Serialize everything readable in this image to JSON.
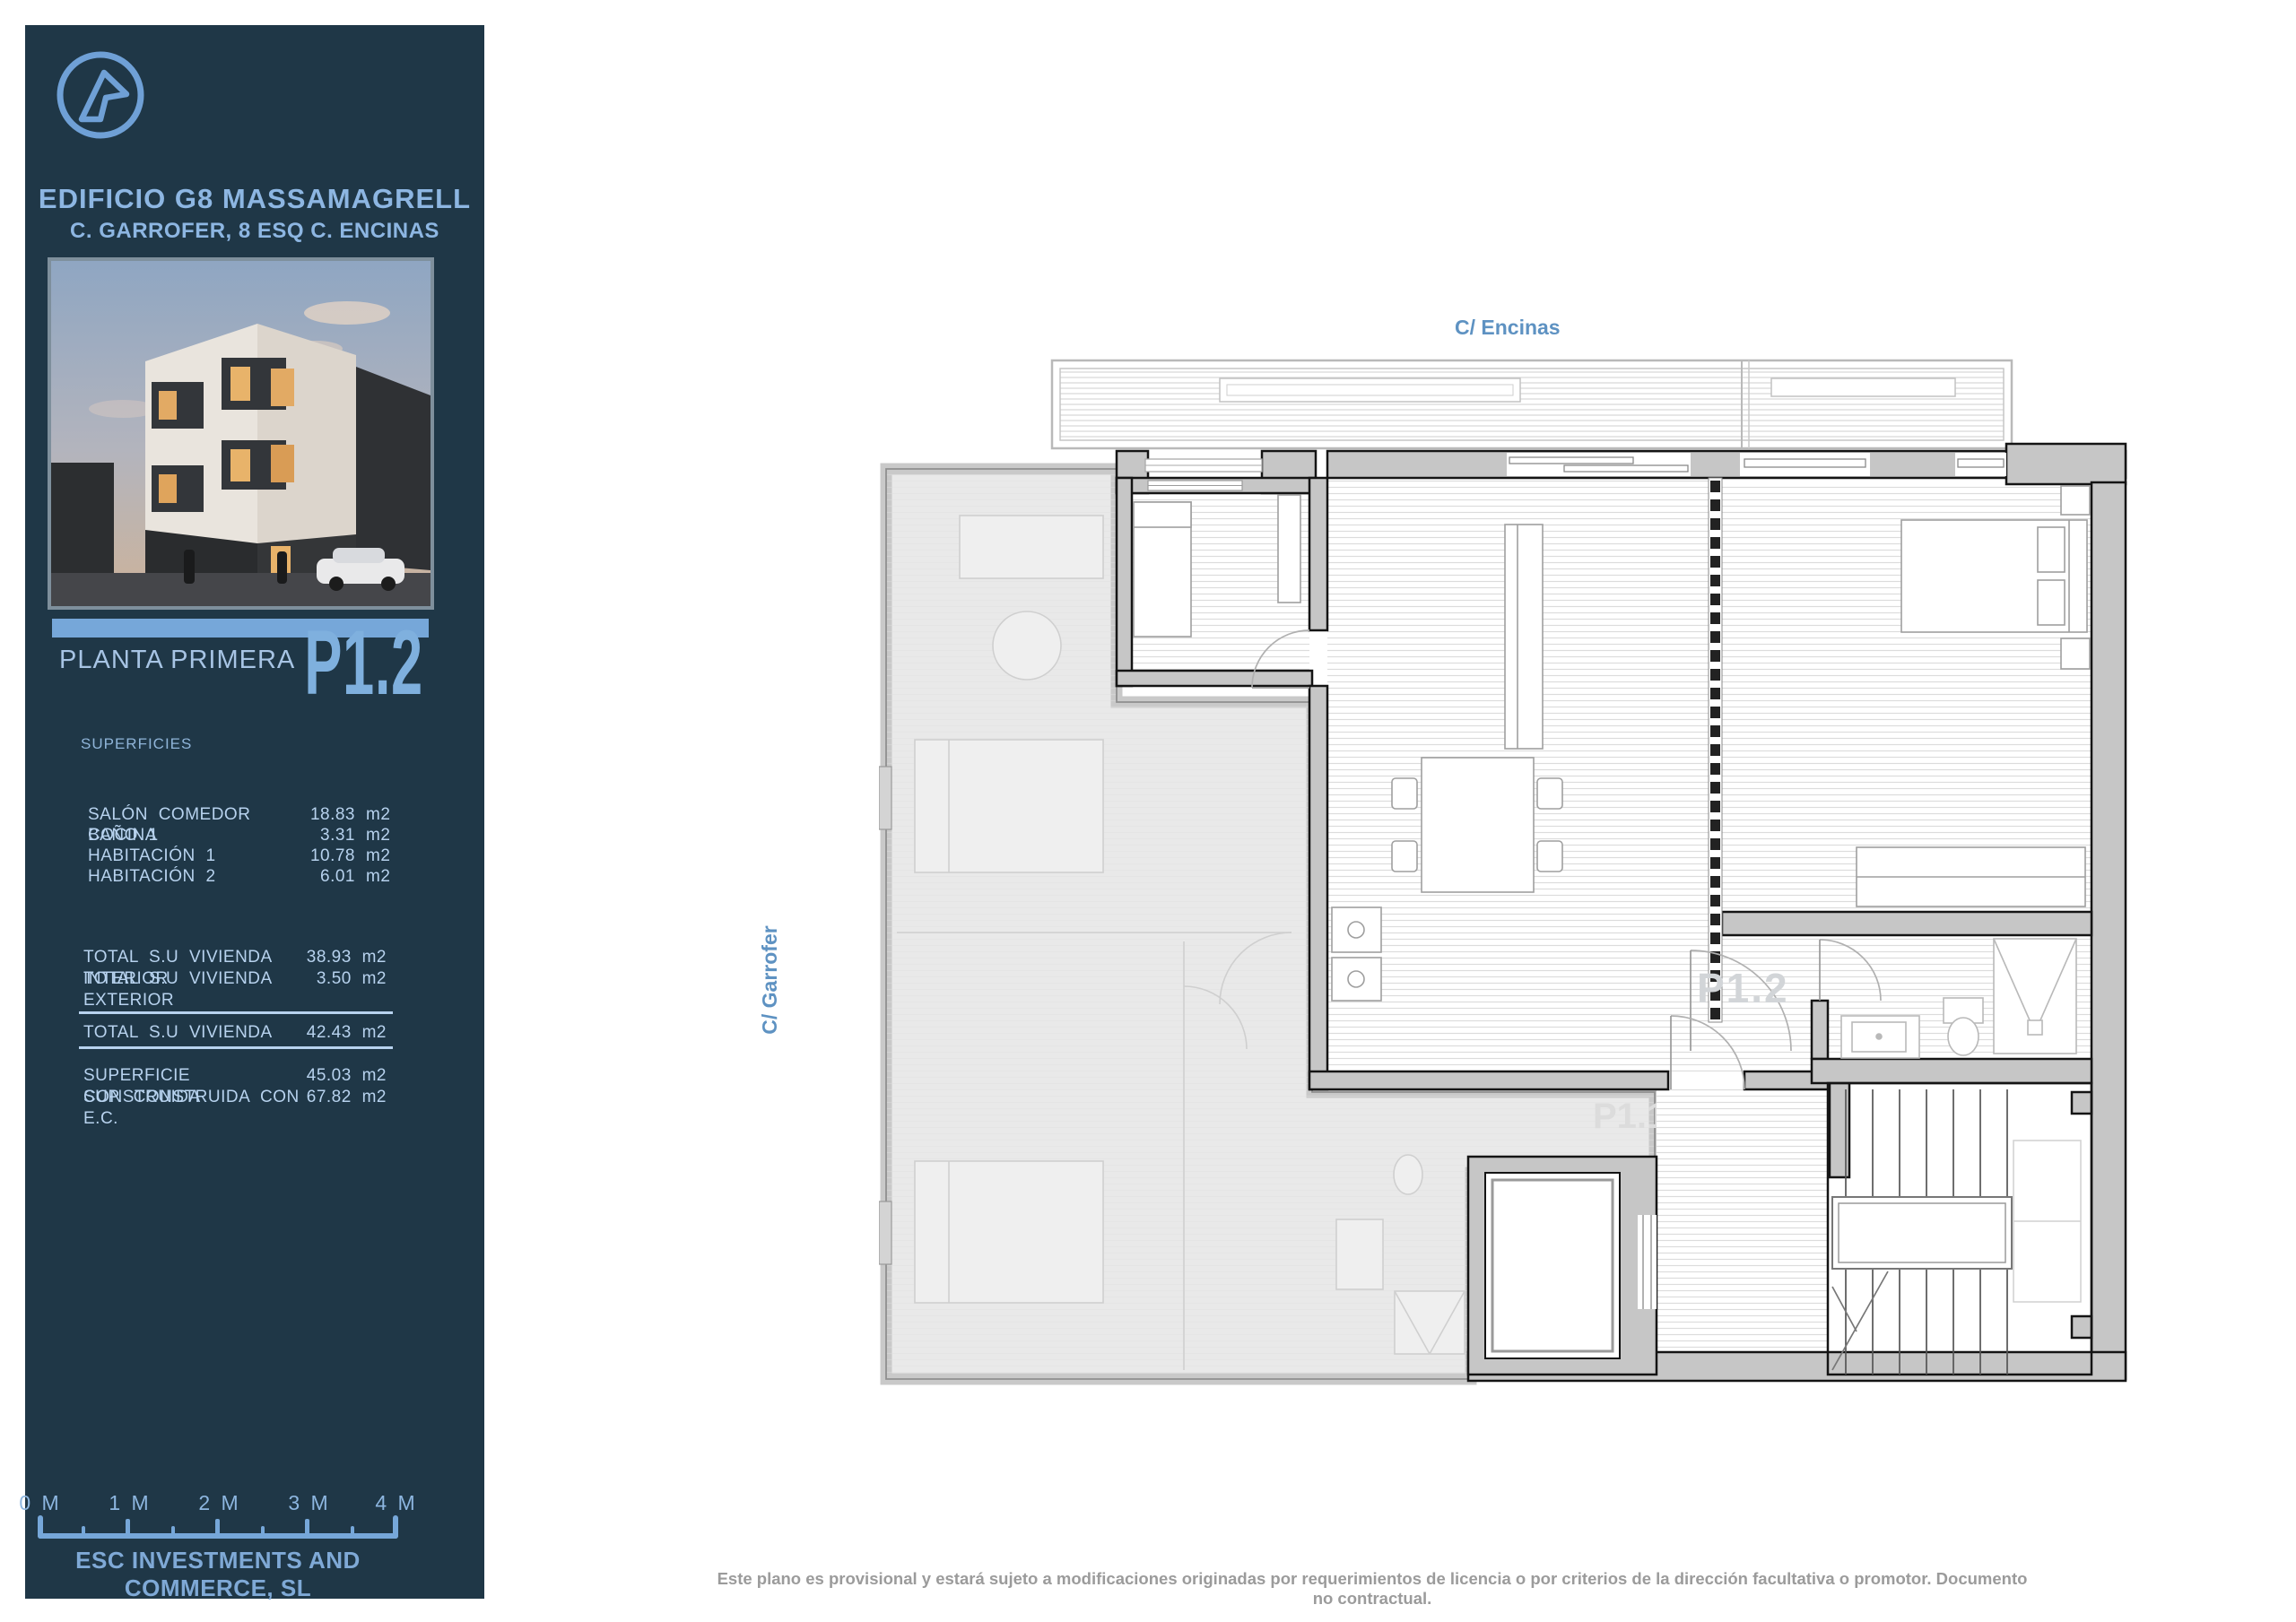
{
  "sidebar": {
    "title": "EDIFICIO G8 MASSAMAGRELL",
    "subtitle": "C. GARROFER, 8 ESQ C. ENCINAS",
    "plan_level_label": "PLANTA PRIMERA",
    "unit_code": "P1.2",
    "surfaces_heading": "SUPERFICIES",
    "rooms": [
      {
        "label": "SALÓN COMEDOR COCINA",
        "value": "18.83",
        "unit": "m2"
      },
      {
        "label": "BAÑO 1",
        "value": "3.31",
        "unit": "m2"
      },
      {
        "label": "HABITACIÓN 1",
        "value": "10.78",
        "unit": "m2"
      },
      {
        "label": "HABITACIÓN 2",
        "value": "6.01",
        "unit": "m2"
      }
    ],
    "totals": [
      {
        "label": "TOTAL S.U VIVIENDA INTERIOR",
        "value": "38.93 m2"
      },
      {
        "label": "TOTAL S.U VIVIENDA EXTERIOR",
        "value": "3.50 m2"
      }
    ],
    "grand_total": {
      "label": "TOTAL S.U VIVIENDA",
      "value": "42.43 m2"
    },
    "built": [
      {
        "label": "SUPERFICIE CONSTRUIDA",
        "value": "45.03 m2"
      },
      {
        "label": "SUP. CONSTRUIDA CON E.C.",
        "value": "67.82 m2"
      }
    ],
    "scale_labels": [
      "0 M",
      "1 M",
      "2 M",
      "3 M",
      "4 M"
    ],
    "company": "ESC INVESTMENTS AND COMMERCE, SL"
  },
  "plan": {
    "street_top": "C/ Encinas",
    "street_left": "C/ Garrofer",
    "unit_watermark": "P1.2",
    "other_unit_watermark": "P1.1"
  },
  "footer": {
    "disclaimer": "Este plano es provisional y estará sujeto a modificaciones originadas por requerimientos de licencia o por criterios de la dirección facultativa o promotor. Documento no contractual."
  },
  "colors": {
    "sidebar_bg": "#1f3747",
    "accent_blue": "#76a7d9",
    "text_blue": "#8db6e2",
    "cad_text": "#b7d2ee",
    "street_label": "#5e92c2",
    "disclaimer_grey": "#9b9b9b"
  }
}
